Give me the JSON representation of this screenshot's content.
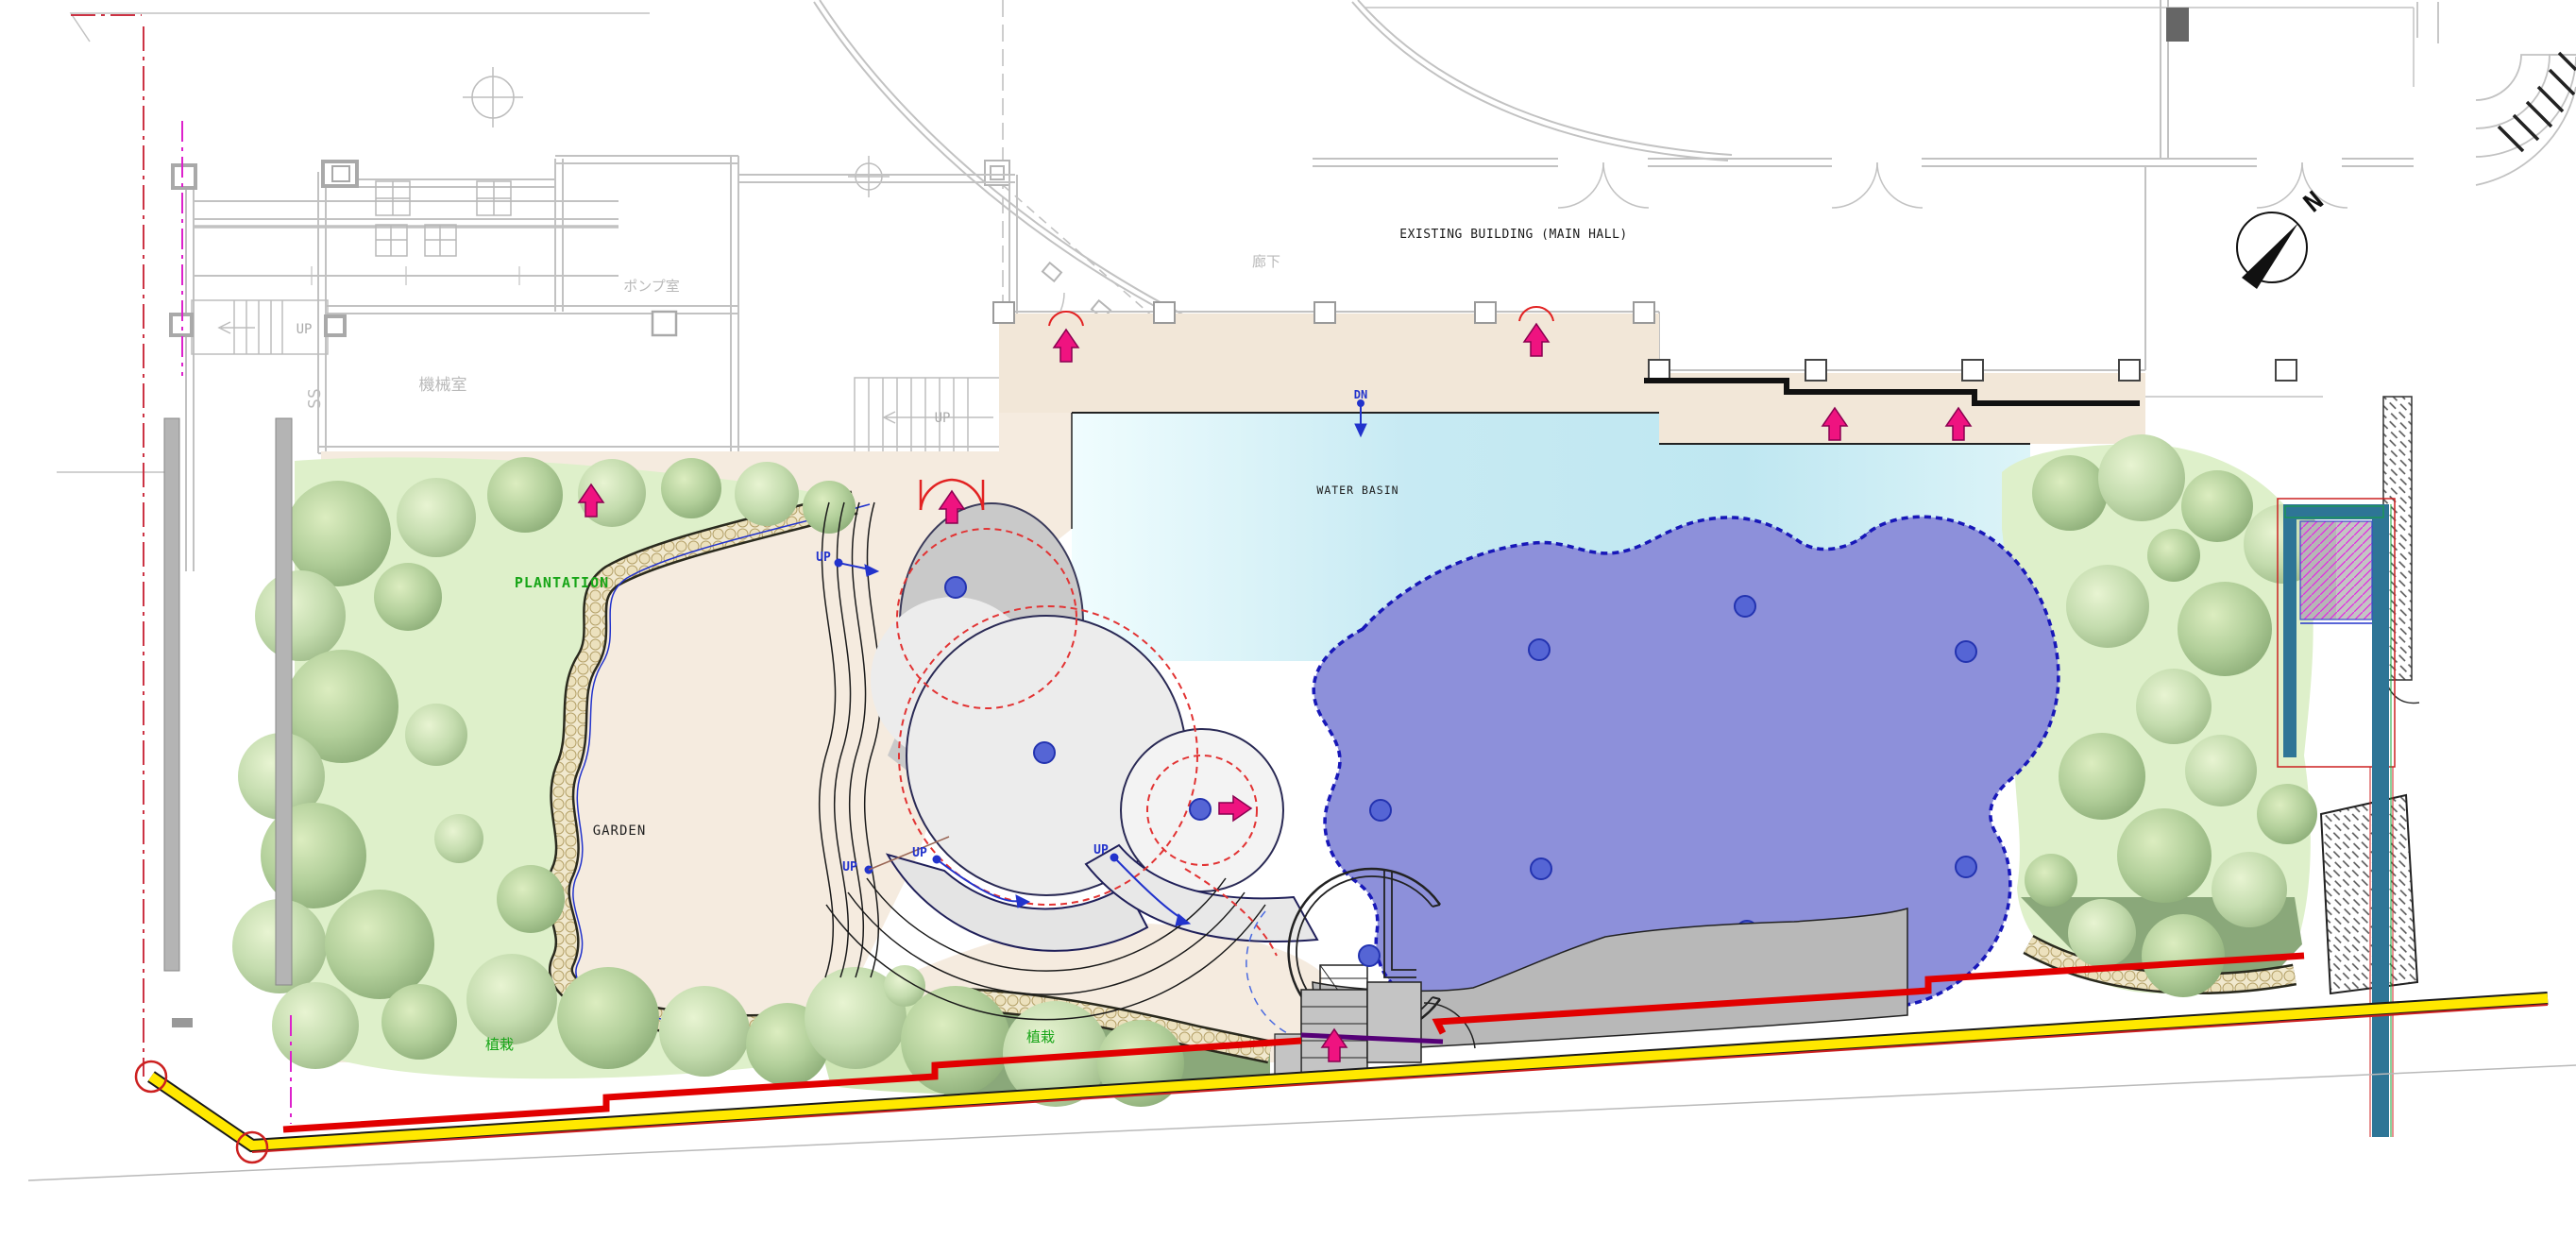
{
  "labels": {
    "existing_building": "EXISTING BUILDING (MAIN HALL)",
    "corridor": "廊下",
    "pump_room": "ポンプ室",
    "machine_room": "機械室",
    "water_basin": "WATER BASIN",
    "plantation": "PLANTATION",
    "garden": "GARDEN",
    "planting": "植栽",
    "up": "UP",
    "down": "DN",
    "north": "N",
    "ss": "SS"
  },
  "colors": {
    "water": "#c7eaf3",
    "pool_purple": "#8d90da",
    "pool_outline": "#1818b8",
    "terrace_beige": "#f2e7d8",
    "garden_beige": "#f5ebdf",
    "plantation_green": "#def0ca",
    "tree_green": "#a8c890",
    "plaza_gray": "#c9c9c9",
    "apron_gray": "#b8b8b8",
    "boundary_yellow": "#ffe800",
    "boundary_red": "#e10000",
    "marker_pink": "#ef1380",
    "label_blue": "#2233cc",
    "label_green": "#17a517",
    "teal_structure": "#2e7596",
    "hatch_magenta": "#e22ae2",
    "cad_gray": "#c2c2c2"
  }
}
